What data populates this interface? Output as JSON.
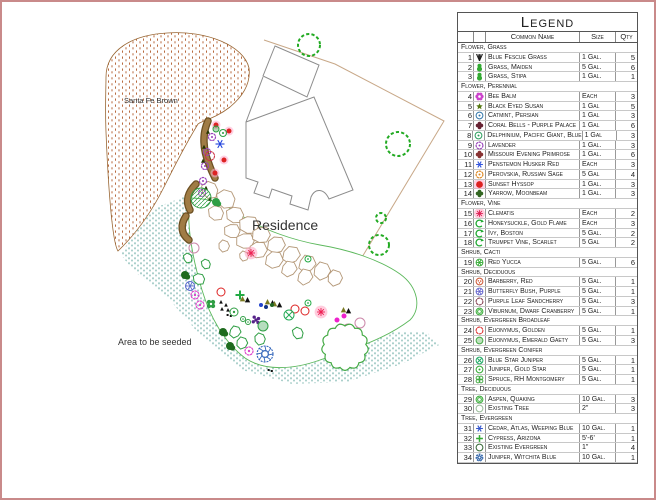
{
  "page": {
    "border_color": "#c98a8a"
  },
  "map": {
    "labels": {
      "santa_fe": "Santa Fe Brown",
      "residence": "Residence",
      "seeded": "Area to be seeded"
    },
    "symbols": [
      {
        "t": "reddot",
        "x": 214,
        "y": 123,
        "r": 2.5,
        "c": "#dd2222"
      },
      {
        "t": "reddot",
        "x": 227,
        "y": 129,
        "r": 2.5,
        "c": "#dd2222"
      },
      {
        "t": "reddot",
        "x": 222,
        "y": 158,
        "r": 2.5,
        "c": "#dd2222"
      },
      {
        "t": "reddot",
        "x": 213,
        "y": 171,
        "r": 2.5,
        "c": "#dd2222"
      },
      {
        "t": "ringdot",
        "x": 221,
        "y": 131,
        "r": 3.5,
        "c": "#2f9e44"
      },
      {
        "t": "snowflake",
        "x": 218,
        "y": 142,
        "r": 4.5,
        "c": "#2244dd"
      },
      {
        "t": "gear",
        "x": 210,
        "y": 135,
        "r": 3.5,
        "c": "#9944bb"
      },
      {
        "t": "gear",
        "x": 205,
        "y": 150,
        "r": 3.5,
        "c": "#9944bb"
      },
      {
        "t": "gear",
        "x": 203,
        "y": 164,
        "r": 3.5,
        "c": "#9944bb"
      },
      {
        "t": "gear",
        "x": 201,
        "y": 179,
        "r": 3.5,
        "c": "#9944bb"
      },
      {
        "t": "gear",
        "x": 200,
        "y": 191,
        "r": 3.5,
        "c": "#9944bb"
      },
      {
        "t": "scallop-ring",
        "x": 208,
        "y": 154,
        "r": 4.5,
        "c": "#cc3344"
      },
      {
        "t": "tri",
        "x": 206,
        "y": 130,
        "r": 2.2,
        "c": "#223300"
      },
      {
        "t": "tri",
        "x": 202,
        "y": 145,
        "r": 2.2,
        "c": "#223300"
      },
      {
        "t": "tri",
        "x": 201,
        "y": 159,
        "r": 2.2,
        "c": "#223300"
      },
      {
        "t": "tri",
        "x": 204,
        "y": 186,
        "r": 2.2,
        "c": "#223300"
      },
      {
        "t": "tri",
        "x": 208,
        "y": 197,
        "r": 2.2,
        "c": "#223300"
      },
      {
        "t": "circle-fill",
        "x": 214,
        "y": 127,
        "r": 3,
        "c": "#2f9e44"
      },
      {
        "t": "hatch-circle",
        "x": 199,
        "y": 196,
        "r": 10,
        "c": "#2f9e44"
      },
      {
        "t": "blob",
        "x": 214,
        "y": 200,
        "r": 4,
        "c": "#2f9e44"
      },
      {
        "t": "ring",
        "x": 192,
        "y": 246,
        "r": 5,
        "c": "#cc88aa"
      },
      {
        "t": "starburst",
        "x": 249,
        "y": 251,
        "r": 4,
        "c": "#ee2255"
      },
      {
        "t": "poly",
        "x": 186,
        "y": 256,
        "r": 5,
        "c": "#2f9e44"
      },
      {
        "t": "poly",
        "x": 204,
        "y": 262,
        "r": 5,
        "c": "#2f9e44"
      },
      {
        "t": "blob",
        "x": 183,
        "y": 273,
        "r": 4,
        "c": "#1e6b1e"
      },
      {
        "t": "poly",
        "x": 197,
        "y": 277,
        "r": 6,
        "c": "#2f9e44"
      },
      {
        "t": "spoke-circle",
        "x": 188,
        "y": 284,
        "r": 4.5,
        "c": "#5566cc"
      },
      {
        "t": "gear",
        "x": 193,
        "y": 293,
        "r": 4,
        "c": "#dd44cc"
      },
      {
        "t": "gear",
        "x": 198,
        "y": 303,
        "r": 4,
        "c": "#dd44cc"
      },
      {
        "t": "flower4",
        "x": 209,
        "y": 302,
        "r": 4,
        "c": "#2f9e44"
      },
      {
        "t": "ring",
        "x": 219,
        "y": 290,
        "r": 4,
        "c": "#dd2222"
      },
      {
        "t": "cross",
        "x": 238,
        "y": 293,
        "r": 4.5,
        "c": "#22aa44"
      },
      {
        "t": "tri",
        "x": 219,
        "y": 300,
        "r": 2,
        "c": "#111111"
      },
      {
        "t": "tri",
        "x": 224,
        "y": 303,
        "r": 2,
        "c": "#111111"
      },
      {
        "t": "tri",
        "x": 220,
        "y": 307,
        "r": 2,
        "c": "#111111"
      },
      {
        "t": "tri",
        "x": 226,
        "y": 308,
        "r": 2,
        "c": "#111111"
      },
      {
        "t": "dots2",
        "x": 227,
        "y": 313,
        "r": 2,
        "c": "#111111"
      },
      {
        "t": "ringdot",
        "x": 232,
        "y": 310,
        "r": 4,
        "c": "#2f9e44"
      },
      {
        "t": "ringdot",
        "x": 241,
        "y": 317,
        "r": 2.5,
        "c": "#2f9e44"
      },
      {
        "t": "ringdot",
        "x": 246,
        "y": 320,
        "r": 2.5,
        "c": "#2f9e44"
      },
      {
        "t": "tripair",
        "x": 243,
        "y": 297,
        "r": 3,
        "c": "#7a7a22"
      },
      {
        "t": "tripair",
        "x": 268,
        "y": 300,
        "r": 3,
        "c": "#7a7a22"
      },
      {
        "t": "tripair",
        "x": 275,
        "y": 302,
        "r": 3,
        "c": "#7a7a22"
      },
      {
        "t": "dot",
        "x": 259,
        "y": 303,
        "r": 2,
        "c": "#2244cc"
      },
      {
        "t": "dot",
        "x": 264,
        "y": 305,
        "r": 2,
        "c": "#113388"
      },
      {
        "t": "dot",
        "x": 270,
        "y": 303,
        "r": 2,
        "c": "#226622"
      },
      {
        "t": "ring",
        "x": 293,
        "y": 307,
        "r": 4,
        "c": "#dd2222"
      },
      {
        "t": "ring",
        "x": 303,
        "y": 309,
        "r": 4,
        "c": "#dd2222"
      },
      {
        "t": "circle-cross",
        "x": 287,
        "y": 313,
        "r": 5,
        "c": "#22aa55"
      },
      {
        "t": "cluster",
        "x": 254,
        "y": 318,
        "r": 4,
        "c": "#552288"
      },
      {
        "t": "circle-fill",
        "x": 261,
        "y": 324,
        "r": 5,
        "c": "#2f9e44"
      },
      {
        "t": "starburst",
        "x": 319,
        "y": 310,
        "r": 4,
        "c": "#ee2255"
      },
      {
        "t": "ringdot",
        "x": 306,
        "y": 301,
        "r": 3,
        "c": "#22aa44"
      },
      {
        "t": "dot",
        "x": 335,
        "y": 318,
        "r": 2.5,
        "c": "#ee22cc"
      },
      {
        "t": "dot",
        "x": 338,
        "y": 324,
        "r": 2.5,
        "c": "#ee22cc"
      },
      {
        "t": "dot",
        "x": 342,
        "y": 314,
        "r": 2.5,
        "c": "#ee22cc"
      },
      {
        "t": "ring",
        "x": 346,
        "y": 327,
        "r": 5,
        "c": "#cc88aa"
      },
      {
        "t": "ring",
        "x": 358,
        "y": 321,
        "r": 5,
        "c": "#cc88aa"
      },
      {
        "t": "tripair",
        "x": 344,
        "y": 308,
        "r": 3,
        "c": "#7a7a22"
      },
      {
        "t": "poly",
        "x": 233,
        "y": 330,
        "r": 6,
        "c": "#2f9e44"
      },
      {
        "t": "blob",
        "x": 221,
        "y": 330,
        "r": 4,
        "c": "#1e6b1e"
      },
      {
        "t": "poly",
        "x": 240,
        "y": 341,
        "r": 6,
        "c": "#2f9e44"
      },
      {
        "t": "blob",
        "x": 228,
        "y": 344,
        "r": 4,
        "c": "#1e6b1e"
      },
      {
        "t": "poly",
        "x": 258,
        "y": 337,
        "r": 6,
        "c": "#2f9e44"
      },
      {
        "t": "gear",
        "x": 247,
        "y": 349,
        "r": 4,
        "c": "#dd44cc"
      },
      {
        "t": "pinwheel",
        "x": 263,
        "y": 352,
        "r": 8,
        "c": "#3366bb"
      },
      {
        "t": "dots2",
        "x": 268,
        "y": 368,
        "r": 2,
        "c": "#111111"
      },
      {
        "t": "poly",
        "x": 296,
        "y": 331,
        "r": 6,
        "c": "#2f9e44"
      },
      {
        "t": "ringdot",
        "x": 306,
        "y": 257,
        "r": 3,
        "c": "#22aa44"
      },
      {
        "t": "tree-dashed",
        "x": 307,
        "y": 43,
        "r": 11,
        "c": "#22aa22"
      },
      {
        "t": "tree-dashed",
        "x": 396,
        "y": 142,
        "r": 12,
        "c": "#22aa22"
      },
      {
        "t": "tree-dashed",
        "x": 379,
        "y": 216,
        "r": 5,
        "c": "#22aa22"
      },
      {
        "t": "tree-dashed",
        "x": 377,
        "y": 243,
        "r": 10,
        "c": "#22aa22"
      },
      {
        "t": "tree-scallop",
        "x": 343,
        "y": 345,
        "r": 21,
        "c": "#44aa44"
      }
    ]
  },
  "legend": {
    "title": "Legend",
    "headers": {
      "name": "Common Name",
      "size": "Size",
      "qty": "Qty"
    },
    "groups": [
      {
        "category": "Flower, Grass",
        "items": [
          {
            "num": "1",
            "sym": "grass",
            "c": "#1a1a1a",
            "name": "Blue Fescue Grass",
            "size": "1 Gal.",
            "qty": "5"
          },
          {
            "num": "2",
            "sym": "balls",
            "c": "#33aa33",
            "name": "Grass, Maiden",
            "size": "5 Gal.",
            "qty": "6"
          },
          {
            "num": "3",
            "sym": "balls",
            "c": "#33aa33",
            "name": "Grass, Stipa",
            "size": "1 Gal.",
            "qty": "1"
          }
        ]
      },
      {
        "category": "Flower, Perennial",
        "items": [
          {
            "num": "4",
            "sym": "flower6",
            "c": "#cc44cc",
            "name": "Bee Balm",
            "size": "Each",
            "qty": "3"
          },
          {
            "num": "5",
            "sym": "star5",
            "c": "#557711",
            "name": "Black Eyed Susan",
            "size": "1 Gal",
            "qty": "5"
          },
          {
            "num": "6",
            "sym": "ringdot",
            "c": "#3377aa",
            "name": "Catmint, Persian",
            "size": "1 Gal",
            "qty": "3"
          },
          {
            "num": "7",
            "sym": "clover",
            "c": "#662233",
            "name": "Coral Bells - Purple Palace",
            "size": "1 Gal",
            "qty": "6"
          },
          {
            "num": "8",
            "sym": "ringdot",
            "c": "#2a9d5c",
            "name": "Delphinium, Pacific Giant, Blue",
            "size": "1 Gal",
            "qty": "3"
          },
          {
            "num": "9",
            "sym": "gear",
            "c": "#9944bb",
            "name": "Lavender",
            "size": "1 Gal.",
            "qty": "3"
          },
          {
            "num": "10",
            "sym": "clover",
            "c": "#883333",
            "name": "Missouri Evening Primrose",
            "size": "1 Gal.",
            "qty": "6"
          },
          {
            "num": "11",
            "sym": "snowflake",
            "c": "#3355dd",
            "name": "Penstemon Husker Red",
            "size": "Each",
            "qty": "3"
          },
          {
            "num": "12",
            "sym": "gear",
            "c": "#dd8822",
            "name": "Perovskia, Russian Sage",
            "size": "5 Gal",
            "qty": "4"
          },
          {
            "num": "13",
            "sym": "reddot",
            "c": "#dd2222",
            "name": "Sunset Hyssop",
            "size": "1 Gal.",
            "qty": "3"
          },
          {
            "num": "14",
            "sym": "clover",
            "c": "#336622",
            "name": "Yarrow, Moonbeam",
            "size": "1 Gal.",
            "qty": "3"
          }
        ]
      },
      {
        "category": "Flower, Vine",
        "items": [
          {
            "num": "15",
            "sym": "starburst",
            "c": "#dd2255",
            "name": "Clematis",
            "size": "Each",
            "qty": "2"
          },
          {
            "num": "16",
            "sym": "vine",
            "c": "#22aa33",
            "name": "Honeysuckle, Gold Flame",
            "size": "Each",
            "qty": "3"
          },
          {
            "num": "17",
            "sym": "vine",
            "c": "#22aa33",
            "name": "Ivy, Boston",
            "size": "5 Gal.",
            "qty": "2"
          },
          {
            "num": "18",
            "sym": "vine",
            "c": "#22aa33",
            "name": "Trumpet Vine, Scarlet",
            "size": "5 Gal",
            "qty": "2"
          }
        ]
      },
      {
        "category": "Shrub, Cacti",
        "items": [
          {
            "num": "19",
            "sym": "circle-asterisk",
            "c": "#33aa33",
            "name": "Red Yucca",
            "size": "5 Gal.",
            "qty": "6"
          }
        ]
      },
      {
        "category": "Shrub, Deciduous",
        "items": [
          {
            "num": "20",
            "sym": "circle-dots",
            "c": "#cc5533",
            "name": "Barberry, Red",
            "size": "5 Gal.",
            "qty": "1"
          },
          {
            "num": "21",
            "sym": "spoke-circle",
            "c": "#6666cc",
            "name": "Butterfly Bush, Purple",
            "size": "5 Gal.",
            "qty": "1"
          },
          {
            "num": "22",
            "sym": "scallop-ring",
            "c": "#884455",
            "name": "Purple Leaf Sandcherry",
            "size": "5 Gal.",
            "qty": "3"
          },
          {
            "num": "23",
            "sym": "ring2",
            "c": "#33aa33",
            "name": "Viburnum, Dwarf Cranberry",
            "size": "5 Gal.",
            "qty": "1"
          }
        ]
      },
      {
        "category": "Shrub, Evergreen Broadleaf",
        "items": [
          {
            "num": "24",
            "sym": "scallop-ring",
            "c": "#dd3333",
            "name": "Euonymus, Golden",
            "size": "5 Gal.",
            "qty": "1"
          },
          {
            "num": "25",
            "sym": "circle-fill",
            "c": "#44aa44",
            "name": "Euonymus, Emerald Gaety",
            "size": "5 Gal.",
            "qty": "3"
          }
        ]
      },
      {
        "category": "Shrub, Evergreen Conifer",
        "items": [
          {
            "num": "26",
            "sym": "circle-cross",
            "c": "#22aa66",
            "name": "Blue Star Juniper",
            "size": "5 Gal.",
            "qty": "1"
          },
          {
            "num": "27",
            "sym": "ringdot",
            "c": "#33aa33",
            "name": "Juniper, Gold Star",
            "size": "5 Gal.",
            "qty": "1"
          },
          {
            "num": "28",
            "sym": "clover4",
            "c": "#44aa44",
            "name": "Spruce, RH Montgomery",
            "size": "5 Gal.",
            "qty": "1"
          }
        ]
      },
      {
        "category": "Tree, Deciduous",
        "items": [
          {
            "num": "29",
            "sym": "ring2",
            "c": "#33aa33",
            "name": "Aspen, Quaking",
            "size": "10 Gal.",
            "qty": "3"
          },
          {
            "num": "30",
            "sym": "ring",
            "c": "#99bb99",
            "name": "Existing Tree",
            "size": "2\"",
            "qty": "3"
          }
        ]
      },
      {
        "category": "Tree, Evergreen",
        "items": [
          {
            "num": "31",
            "sym": "snowflake",
            "c": "#3355cc",
            "name": "Cedar, Atlas, Weeping Blue",
            "size": "10 Gal.",
            "qty": "1"
          },
          {
            "num": "32",
            "sym": "cross",
            "c": "#33aa33",
            "name": "Cypress, Arizona",
            "size": "5'-6'",
            "qty": "1"
          },
          {
            "num": "33",
            "sym": "ring",
            "c": "#336633",
            "name": "Existing Evergreen",
            "size": "1\"",
            "qty": "4"
          },
          {
            "num": "34",
            "sym": "pinwheel",
            "c": "#3366aa",
            "name": "Juniper, Witchita Blue",
            "size": "10 Gal.",
            "qty": "1"
          }
        ]
      }
    ]
  }
}
